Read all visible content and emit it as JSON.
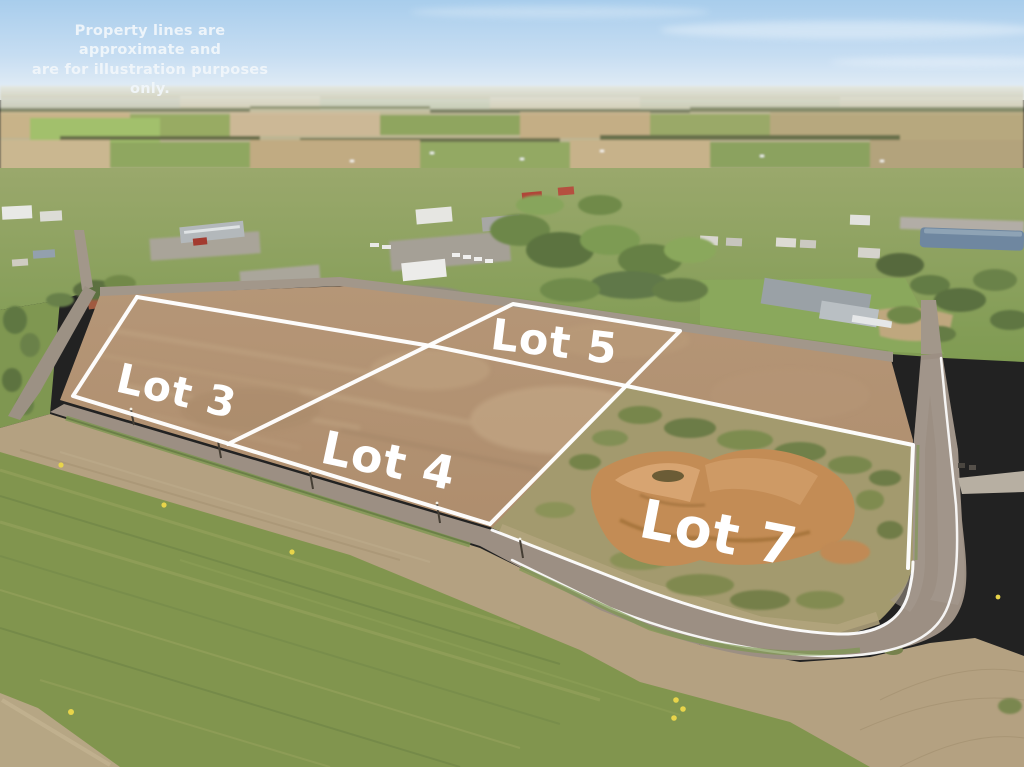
{
  "disclaimer": {
    "line1": "Property lines are approximate and",
    "line2": "are for illustration purposes only."
  },
  "lots": [
    {
      "label": "Lot 3"
    },
    {
      "label": "Lot 4"
    },
    {
      "label": "Lot 5"
    },
    {
      "label": "Lot 7"
    }
  ],
  "palette": {
    "property-line": "#ffffff",
    "label-text": "#ffffff",
    "disclaimer-text": "#f2f7fb",
    "sky-top": "#a8cdec",
    "sky-horizon": "#eaf1f7",
    "plowed-dirt": "#b19070",
    "grass-field": "#81954e",
    "road-asphalt": "#9c8f83",
    "excavation-dirt": "#c38c55",
    "pond-water": "#6f87a0",
    "marker-yellow": "#e8d44a"
  }
}
